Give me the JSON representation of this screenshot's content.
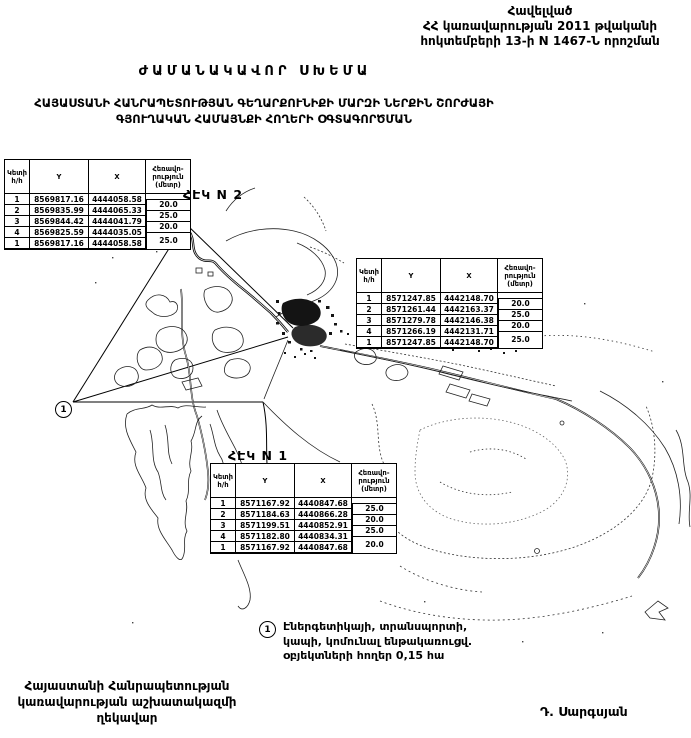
{
  "page": {
    "appendix": "Հավելված\nՀՀ կառավարության 2011 թվականի\nհոկտեմբերի 13-ի N 1467-Ն որոշման",
    "title": "ԺԱՄԱՆԱԿԱՎՈՐ ՍԽԵՄԱ",
    "subtitle": "ՀԱՅԱՍՏԱՆԻ ՀԱՆՐԱՊԵՏՈՒԹՅԱՆ ԳԵՂԱՐՔՈՒՆԻՔԻ ՄԱՐԶԻ ՆԵՐՔԻՆ ՇՈՐԺԱՅԻ\nԳՅՈՒՂԱԿԱՆ ՀԱՄԱՅՆՔԻ ՀՈՂԵՐԻ ՕԳՏԱԳՈՐԾՄԱՆ",
    "footer_left": "Հայաստանի Հանրապետության\nկառավարության աշխատակազմի\nղեկավար",
    "signature": "Դ. Սարգսյան"
  },
  "map": {
    "label_hek2": "ՀԷԿ N 2",
    "label_hek1": "ՀԷԿ N 1",
    "marker_1": "1",
    "legend": {
      "symbol": "1",
      "text": "Էներգետիկայի, տրանսպորտի,\nկապի, կոմունալ ենթակառուցվ.\nօբյեկտների հողեր 0,15 հա"
    }
  },
  "tables": [
    {
      "headers": [
        "Կետի հ/հ",
        "Y",
        "X",
        "Հեռավո-րություն (մետր)"
      ],
      "rows": [
        [
          "1",
          "8569817.16",
          "4444058.58"
        ],
        [
          "2",
          "8569835.99",
          "4444065.33"
        ],
        [
          "3",
          "8569844.42",
          "4444041.79"
        ],
        [
          "4",
          "8569825.59",
          "4444035.05"
        ],
        [
          "1",
          "8569817.16",
          "4444058.58"
        ]
      ],
      "distances": [
        "20.0",
        "25.0",
        "20.0",
        "25.0"
      ]
    },
    {
      "headers": [
        "Կետի հ/հ",
        "Y",
        "X",
        "Հեռավո-րություն (մետր)"
      ],
      "rows": [
        [
          "1",
          "8571247.85",
          "4442148.70"
        ],
        [
          "2",
          "8571261.44",
          "4442163.37"
        ],
        [
          "3",
          "8571279.78",
          "4442146.38"
        ],
        [
          "4",
          "8571266.19",
          "4442131.71"
        ],
        [
          "1",
          "8571247.85",
          "4442148.70"
        ]
      ],
      "distances": [
        "20.0",
        "25.0",
        "20.0",
        "25.0"
      ]
    },
    {
      "headers": [
        "Կետի հ/հ",
        "Y",
        "X",
        "Հեռավո-րություն (մետր)"
      ],
      "rows": [
        [
          "1",
          "8571167.92",
          "4440847.68"
        ],
        [
          "2",
          "8571184.63",
          "4440866.28"
        ],
        [
          "3",
          "8571199.51",
          "4440852.91"
        ],
        [
          "4",
          "8571182.80",
          "4440834.31"
        ],
        [
          "1",
          "8571167.92",
          "4440847.68"
        ]
      ],
      "distances": [
        "25.0",
        "20.0",
        "25.0",
        "20.0"
      ]
    }
  ]
}
